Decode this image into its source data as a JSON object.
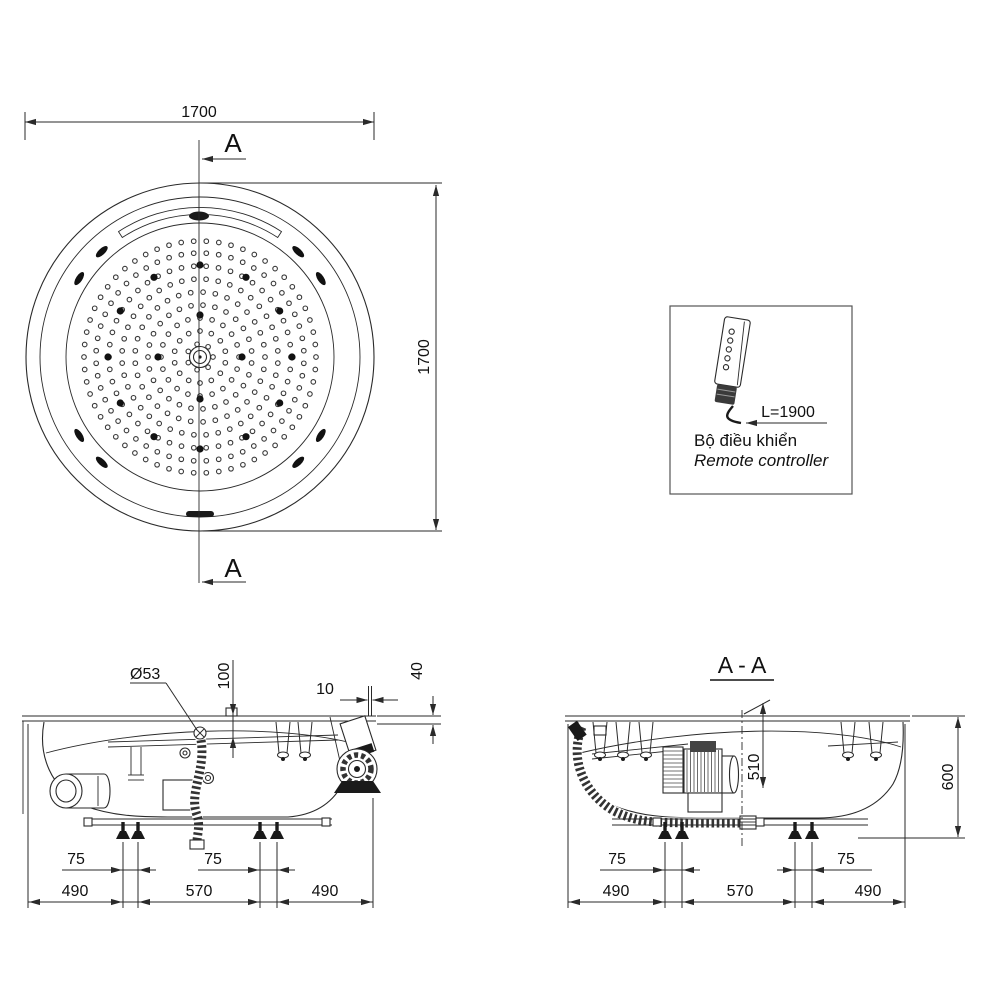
{
  "top_view": {
    "width_label": "1700",
    "height_label": "1700",
    "section_marker_top": "A",
    "section_marker_bottom": "A"
  },
  "remote": {
    "length_label": "L=1900",
    "name_vi": "Bộ điều khiển",
    "name_en": "Remote controller"
  },
  "front_view": {
    "drain_label": "Ø53",
    "depth_label": "100",
    "gap_label": "10",
    "rim_label": "40",
    "foot_span_left": "75",
    "foot_span_right": "75",
    "span_left": "490",
    "span_center": "570",
    "span_right": "490"
  },
  "section_view": {
    "title": "A - A",
    "inner_depth_label": "510",
    "height_label": "600",
    "foot_span_left": "75",
    "foot_span_right": "75",
    "span_left": "490",
    "span_center": "570",
    "span_right": "490"
  },
  "colors": {
    "line": "#2a2a2a",
    "dark_fill": "#1a1a1a",
    "background": "#ffffff"
  }
}
